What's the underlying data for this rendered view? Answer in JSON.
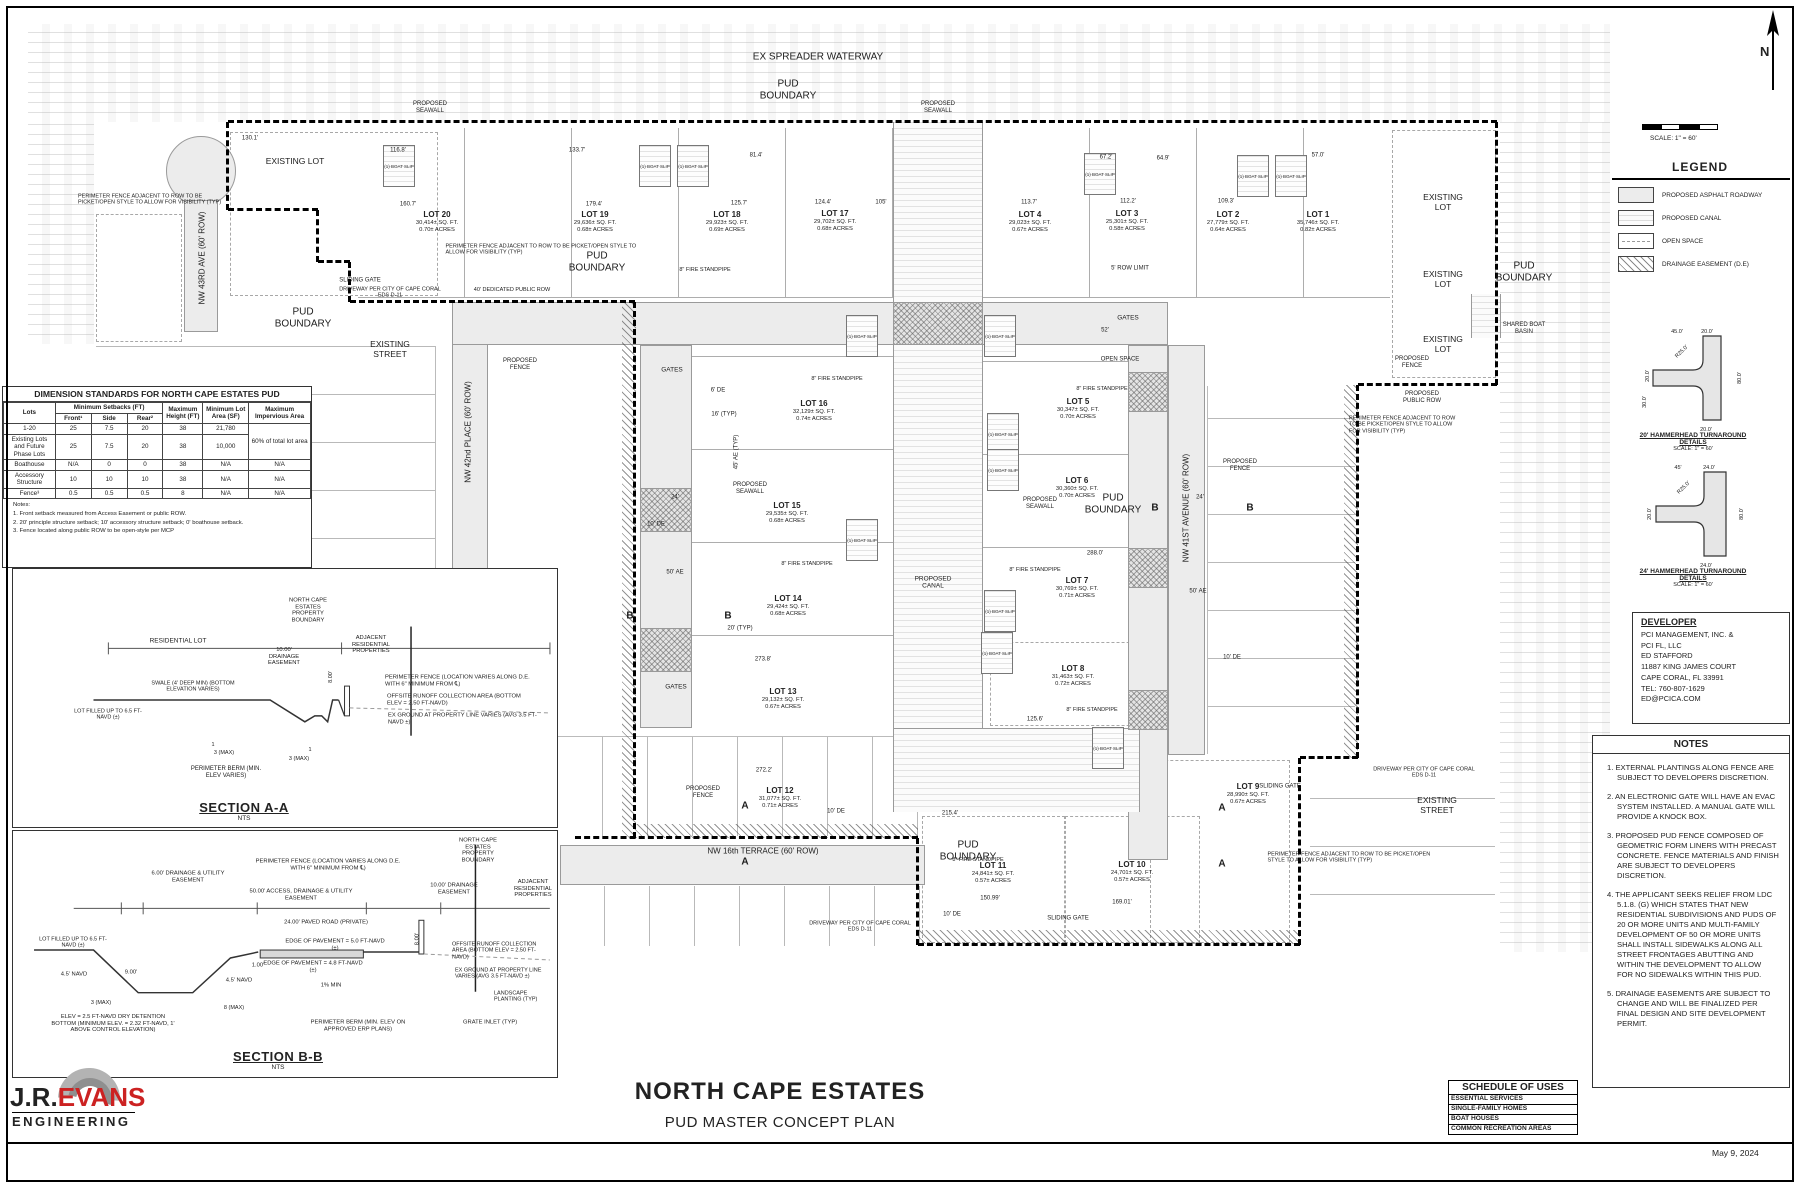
{
  "sheet": {
    "project_title": "NORTH CAPE ESTATES",
    "sheet_title": "PUD MASTER CONCEPT PLAN",
    "date": "May 9, 2024"
  },
  "logo": {
    "jr": "J.R.",
    "evans": "EVANS",
    "engineering": "ENGINEERING",
    "accent_color": "#cc2222"
  },
  "compass": {
    "label": "N"
  },
  "scalebar": {
    "label": "SCALE: 1\" = 60'"
  },
  "legend": {
    "title": "LEGEND",
    "items": [
      {
        "label": "PROPOSED ASPHALT ROADWAY",
        "swatch": "roadway"
      },
      {
        "label": "PROPOSED CANAL",
        "swatch": "canal"
      },
      {
        "label": "OPEN SPACE",
        "swatch": "openspace"
      },
      {
        "label": "DRAINAGE EASEMENT (D.E)",
        "swatch": "drainage"
      }
    ]
  },
  "details": {
    "h20": {
      "title": "20' HAMMERHEAD TURNAROUND",
      "subtitle": "DETAILS",
      "scale": "SCALE: 1\" = 60'",
      "dims": [
        "45.0'",
        "20.0'",
        "R25.0'",
        "20.0'",
        "30.0'",
        "80.0'",
        "20.0'"
      ]
    },
    "h24": {
      "title": "24' HAMMERHEAD TURNAROUND",
      "subtitle": "DETAILS",
      "scale": "SCALE: 1\" = 60'",
      "dims": [
        "45'",
        "24.0'",
        "R25.0'",
        "20.0'",
        "80.0'",
        "24.0'"
      ]
    }
  },
  "developer": {
    "title": "DEVELOPER",
    "lines": [
      "PCI MANAGEMENT, INC. &",
      "PCI FL, LLC",
      "ED STAFFORD",
      "11887 KING JAMES COURT",
      "CAPE CORAL, FL 33991",
      "TEL: 760-807-1629",
      "ED@PCICA.COM"
    ]
  },
  "notes": {
    "title": "NOTES",
    "items": [
      "1.  EXTERNAL PLANTINGS ALONG FENCE ARE SUBJECT TO DEVELOPERS DISCRETION.",
      "2. AN ELECTRONIC GATE WILL HAVE  AN EVAC SYSTEM INSTALLED. A MANUAL GATE WILL PROVIDE A KNOCK BOX.",
      "3. PROPOSED PUD FENCE COMPOSED OF GEOMETRIC FORM LINERS WITH PRECAST CONCRETE. FENCE MATERIALS AND FINISH ARE SUBJECT TO DEVELOPERS DISCRETION.",
      "4. THE APPLICANT SEEKS RELIEF FROM LDC 5.1.8. (G) WHICH STATES THAT NEW RESIDENTIAL SUBDIVISIONS AND PUDS OF 20 OR MORE UNITS AND MULTI-FAMILY DEVELOPMENT OF 50 OR MORE UNITS SHALL INSTALL SIDEWALKS ALONG ALL STREET FRONTAGES ABUTTING AND WITHIN THE DEVELOPMENT TO ALLOW FOR NO SIDEWALKS WITHIN THIS PUD.",
      "5.  DRAINAGE EASEMENTS ARE SUBJECT TO CHANGE AND WILL BE FINALIZED PER FINAL DESIGN AND SITE DEVELOPMENT PERMIT."
    ]
  },
  "schedule": {
    "title": "SCHEDULE OF USES",
    "rows": [
      "ESSENTIAL SERVICES",
      "SINGLE-FAMILY HOMES",
      "BOAT HOUSES",
      "COMMON RECREATION AREAS"
    ]
  },
  "standards": {
    "title": "DIMENSION STANDARDS FOR NORTH CAPE ESTATES PUD",
    "col_lots": "Lots",
    "setbacks_header": "Minimum Setbacks (FT)",
    "col_front": "Front¹",
    "col_side": "Side",
    "col_rear": "Rear²",
    "col_height": "Maximum Height (FT)",
    "col_area": "Minimum Lot Area (SF)",
    "col_imperv": "Maximum Impervious Area",
    "rows": [
      [
        "1-20",
        "25",
        "7.5",
        "20",
        "38",
        "21,780",
        "60% of total lot area"
      ],
      [
        "Existing Lots and Future Phase Lots",
        "25",
        "7.5",
        "20",
        "38",
        "10,000",
        ""
      ],
      [
        "Boathouse",
        "N/A",
        "0",
        "0",
        "38",
        "N/A",
        "N/A"
      ],
      [
        "Accessory Structure",
        "10",
        "10",
        "10",
        "38",
        "N/A",
        "N/A"
      ],
      [
        "Fence³",
        "0.5",
        "0.5",
        "0.5",
        "8",
        "N/A",
        "N/A"
      ]
    ],
    "notes_label": "Notes:",
    "notes": [
      "1.  Front setback measured from Access Easement or public ROW.",
      "2.  20' principle structure setback; 10' accessory structure setback; 0' boathouse setback.",
      "3.  Fence located along public ROW to be open-style per MCP"
    ]
  },
  "section_a": {
    "caption": "SECTION A-A",
    "scale": "NTS",
    "labels": {
      "residential_lot": "RESIDENTIAL LOT",
      "de10": "10.00' DRAINAGE EASEMENT",
      "boundary": "NORTH CAPE ESTATES PROPERTY BOUNDARY",
      "adjacent": "ADJACENT RESIDENTIAL PROPERTIES",
      "fence": "PERIMETER FENCE (LOCATION VARIES ALONG D.E. WITH 6\" MINIMUM FROM ℄)",
      "offsite": "OFFSITE RUNOFF COLLECTION AREA (BOTTOM ELEV = 2.50 FT-NAVD)",
      "exground": "EX GROUND AT PROPERTY LINE VARIES (AVG 3.5 FT-NAVD ±)",
      "swale": "SWALE (4' DEEP MIN) (BOTTOM ELEVATION VARIES)",
      "lot_filled": "LOT FILLED UP TO 6.5 FT-NAVD (±)",
      "berm": "PERIMETER BERM (MIN. ELEV VARIES)",
      "d8": "8.00'",
      "slope1": "3 (MAX)",
      "slope2": "3 (MAX)",
      "one1": "1",
      "one2": "1"
    }
  },
  "section_b": {
    "caption": "SECTION B-B",
    "scale": "NTS",
    "labels": {
      "lot_filled": "LOT FILLED UP TO 6.5 FT-NAVD (±)",
      "navd45a": "4.5' NAVD",
      "navd45b": "4.5' NAVD",
      "d900": "9.00'",
      "d100": "1.00'",
      "de6": "6.00' DRAINAGE & UTILITY EASEMENT",
      "ade50": "50.00' ACCESS, DRAINAGE & UTILITY EASEMENT",
      "paved": "24.00' PAVED ROAD (PRIVATE)",
      "fence": "PERIMETER FENCE (LOCATION VARIES ALONG D.E. WITH 6\" MINIMUM FROM ℄)",
      "boundary": "NORTH CAPE ESTATES PROPERTY BOUNDARY",
      "de10": "10.00' DRAINAGE EASEMENT",
      "adjacent": "ADJACENT RESIDENTIAL PROPERTIES",
      "eop5": "EDGE OF PAVEMENT = 5.0 FT-NAVD (±)",
      "eop48": "EDGE OF PAVEMENT = 4.8 FT-NAVD (±)",
      "pct": "1% MIN",
      "d800": "8.00'",
      "detention": "ELEV = 2.5 FT-NAVD DRY DETENTION BOTTOM (MINIMUM ELEV. = 2.32 FT-NAVD, 1' ABOVE CONTROL ELEVATION)",
      "slope3": "3 (MAX)",
      "slope8": "8 (MAX)",
      "berm": "PERIMETER BERM (MIN. ELEV ON APPROVED ERP PLANS)",
      "offsite": "OFFSITE RUNOFF COLLECTION AREA (BOTTOM ELEV = 2.50 FT-NAVD)",
      "exground": "EX GROUND AT PROPERTY LINE VARIES (AVG 3.5 FT-NAVD ±)",
      "landscape": "LANDSCAPE PLANTING (TYP)",
      "grate": "GRATE INLET (TYP)"
    }
  },
  "plan": {
    "boat_slip_label": "(1) BOAT SLIP",
    "streets": {
      "st43": "NW 43RD AVE (60' ROW)",
      "st42": "NW 42nd PLACE (60' ROW)",
      "st41": "NW 41ST AVENUE (60' ROW)",
      "st16": "NW 16th TERRACE (60' ROW)"
    },
    "lots": [
      {
        "name": "LOT 1",
        "sqft": "35,746± SQ. FT.",
        "acres": "0.82± ACRES"
      },
      {
        "name": "LOT 2",
        "sqft": "27,779± SQ. FT.",
        "acres": "0.64± ACRES"
      },
      {
        "name": "LOT 3",
        "sqft": "25,301± SQ. FT.",
        "acres": "0.58± ACRES"
      },
      {
        "name": "LOT 4",
        "sqft": "29,023± SQ. FT.",
        "acres": "0.67± ACRES"
      },
      {
        "name": "LOT 5",
        "sqft": "30,347± SQ. FT.",
        "acres": "0.70± ACRES"
      },
      {
        "name": "LOT 6",
        "sqft": "30,360± SQ. FT.",
        "acres": "0.70± ACRES"
      },
      {
        "name": "LOT 7",
        "sqft": "30,769± SQ. FT.",
        "acres": "0.71± ACRES"
      },
      {
        "name": "LOT 8",
        "sqft": "31,463± SQ. FT.",
        "acres": "0.72± ACRES"
      },
      {
        "name": "LOT 9",
        "sqft": "28,990± SQ. FT.",
        "acres": "0.67± ACRES"
      },
      {
        "name": "LOT 10",
        "sqft": "24,701± SQ. FT.",
        "acres": "0.57± ACRES"
      },
      {
        "name": "LOT 11",
        "sqft": "24,841± SQ. FT.",
        "acres": "0.57± ACRES"
      },
      {
        "name": "LOT 12",
        "sqft": "31,077± SQ. FT.",
        "acres": "0.71± ACRES"
      },
      {
        "name": "LOT 13",
        "sqft": "29,132± SQ. FT.",
        "acres": "0.67± ACRES"
      },
      {
        "name": "LOT 14",
        "sqft": "29,424± SQ. FT.",
        "acres": "0.68± ACRES"
      },
      {
        "name": "LOT 15",
        "sqft": "29,535± SQ. FT.",
        "acres": "0.68± ACRES"
      },
      {
        "name": "LOT 16",
        "sqft": "32,129± SQ. FT.",
        "acres": "0.74± ACRES"
      },
      {
        "name": "LOT 17",
        "sqft": "29,702± SQ. FT.",
        "acres": "0.68± ACRES"
      },
      {
        "name": "LOT 18",
        "sqft": "29,923± SQ. FT.",
        "acres": "0.69± ACRES"
      },
      {
        "name": "LOT 19",
        "sqft": "29,636± SQ. FT.",
        "acres": "0.68± ACRES"
      },
      {
        "name": "LOT 20",
        "sqft": "30,414± SQ. FT.",
        "acres": "0.70± ACRES"
      }
    ],
    "annotations": {
      "waterway": "EX SPREADER WATERWAY",
      "pud1": "PUD BOUNDARY",
      "pud2": "PUD BOUNDARY",
      "pud3": "PUD BOUNDARY",
      "pud4": "PUD BOUNDARY",
      "pud5": "PUD BOUNDARY",
      "pud6": "PUD BOUNDARY",
      "exlot_tl": "EXISTING LOT",
      "exlot_r1": "EXISTING LOT",
      "exlot_r2": "EXISTING LOT",
      "exlot_r3": "EXISTING LOT",
      "exst_l": "EXISTING STREET",
      "exst_r": "EXISTING STREET",
      "seaw1": "PROPOSED SEAWALL",
      "seaw2": "PROPOSED SEAWALL",
      "seaw3": "PROPOSED SEAWALL",
      "seaw4": "PROPOSED SEAWALL",
      "canal_lbl": "PROPOSED CANAL",
      "pfnote1": "PERIMETER FENCE ADJACENT TO ROW TO BE PICKET/OPEN STYLE TO ALLOW FOR VISIBILITY (TYP)",
      "pfnote2": "PERIMETER FENCE ADJACENT TO ROW TO BE PICKET/OPEN STYLE TO ALLOW FOR VISIBILITY (TYP)",
      "pfnote3": "PERIMETER FENCE ADJACENT TO ROW TO BE PICKET/OPEN STYLE TO ALLOW FOR VISIBILITY (TYP)",
      "pfnote4": "PERIMETER FENCE ADJACENT TO ROW TO BE PICKET/OPEN STYLE TO ALLOW FOR VISIBILITY (TYP)",
      "slide1": "SLIDING GATE",
      "slide2": "SLIDING GATE",
      "slide3": "SLIDING GATE",
      "gates1": "GATES",
      "gates2": "GATES",
      "gates3": "GATES",
      "drive1": "DRIVEWAY PER CITY OF CAPE CORAL EDS D-11",
      "drive2": "DRIVEWAY PER CITY OF CAPE CORAL EDS D-11",
      "drive3": "DRIVEWAY PER CITY OF CAPE CORAL EDS D-11",
      "dedrow": "40' DEDICATED PUBLIC ROW",
      "pfen1": "PROPOSED FENCE",
      "pfen2": "PROPOSED FENCE",
      "pfen3": "PROPOSED FENCE",
      "pfen4": "PROPOSED FENCE",
      "pubrow": "PROPOSED PUBLIC ROW",
      "basin": "SHARED BOAT BASIN",
      "open1": "OPEN SPACE",
      "rowlim": "5' ROW LIMIT",
      "sp1": "8\" FIRE STANDPIPE",
      "sp2": "8\" FIRE STANDPIPE",
      "sp3": "8\" FIRE STANDPIPE",
      "sp4": "8\" FIRE STANDPIPE",
      "sp5": "8\" FIRE STANDPIPE",
      "sp6": "8\" FIRE STANDPIPE",
      "sp7": "8\" FIRE STANDPIPE",
      "mA1": "A",
      "mA2": "A",
      "mA3": "A",
      "mA4": "A",
      "mB1": "B",
      "mB2": "B",
      "mB3": "B",
      "mB4": "B",
      "dm1": "130.1'",
      "dm2": "116.8'",
      "dm3": "133.7'",
      "dm4": "81.4'",
      "dm5": "160.7'",
      "dm6": "179.4'",
      "dm7": "125.7'",
      "dm8": "124.4'",
      "dm9": "105'",
      "dm10": "113.7'",
      "dm11": "67.2'",
      "dm12": "64.9'",
      "dm13": "112.2'",
      "dm14": "109.3'",
      "dm15": "57.0'",
      "dm16": "273.8'",
      "dm17": "272.2'",
      "dm18": "215.4'",
      "dm19": "288.0'",
      "dm20": "150.99'",
      "dm21": "169.01'",
      "dm22": "125.6'",
      "dm23": "45' AE (TYP)",
      "dm24": "50' AE",
      "dm25": "24'",
      "dm26": "10' DE",
      "dm27": "6' DE",
      "dm28": "16' (TYP)",
      "dm29": "20' (TYP)",
      "dm30": "50' AE",
      "dm31": "24'",
      "dm32": "10' DE",
      "dm33": "10' DE",
      "dm34": "52'",
      "dm35": "10' DE"
    }
  }
}
